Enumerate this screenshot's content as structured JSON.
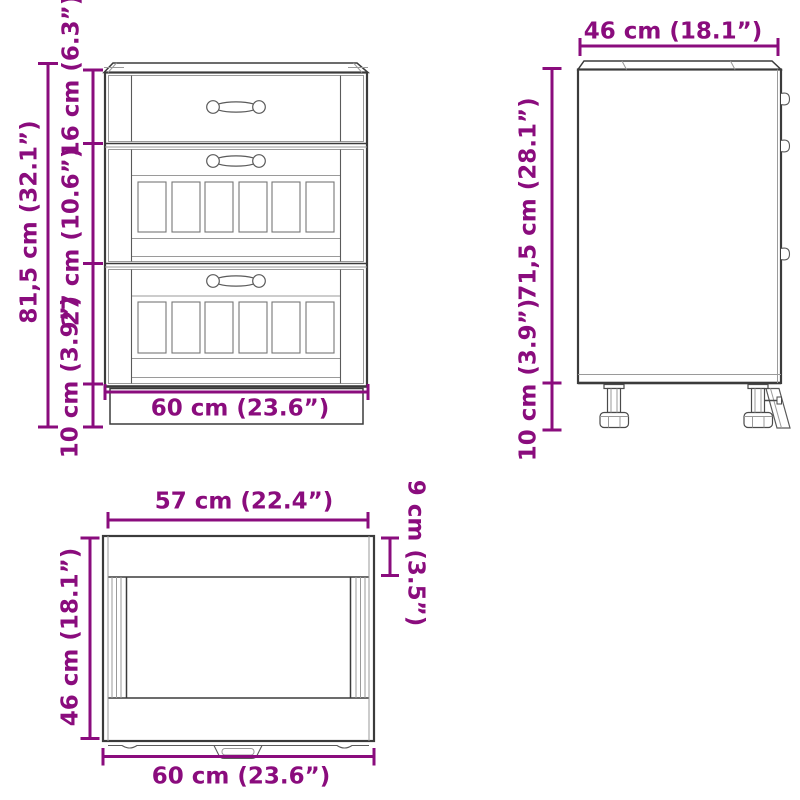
{
  "colors": {
    "dimension_accent": "#8a0c7d",
    "outline": "#3b3b3b",
    "detail": "#8f8f8f",
    "background": "#ffffff"
  },
  "views": {
    "front": {
      "dimensions": {
        "total_height": "81,5 cm (32.1”)",
        "top_drawer_height": "16 cm (6.3”)",
        "middle_drawer_height": "27 cm (10.6”)",
        "plinth_height": "10 cm (3.9”)",
        "width": "60 cm (23.6”)"
      }
    },
    "side": {
      "dimensions": {
        "depth": "46 cm (18.1”)",
        "body_height": "71,5 cm (28.1”)",
        "leg_height": "10 cm (3.9”)"
      }
    },
    "top": {
      "dimensions": {
        "inner_width": "57 cm (22.4”)",
        "front_edge_depth": "9 cm (3.5”)",
        "depth": "46 cm (18.1”)",
        "width": "60 cm (23.6”)"
      }
    }
  }
}
